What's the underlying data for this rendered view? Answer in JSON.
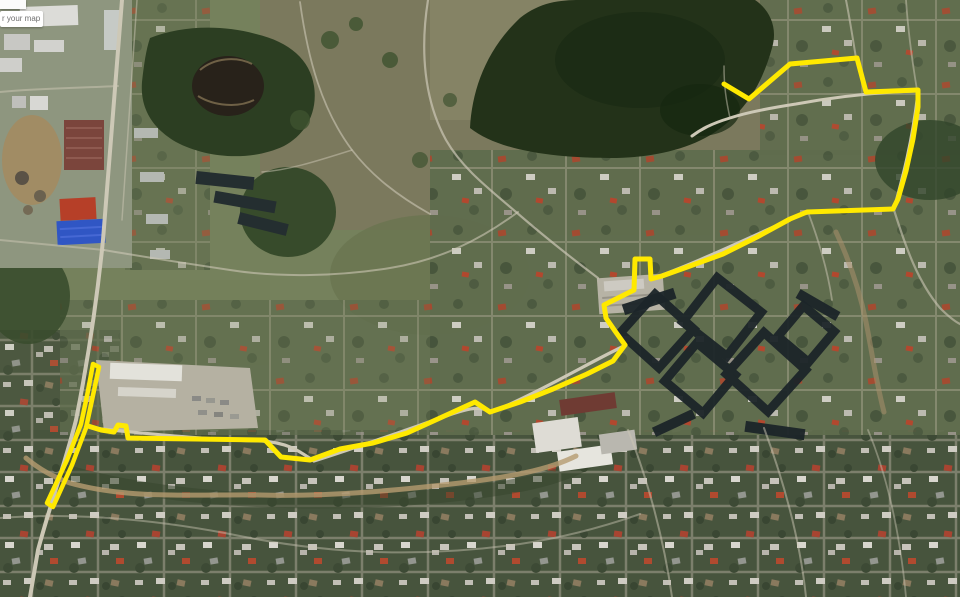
{
  "map_overlay": {
    "partial_label_text": "r your map"
  },
  "route": {
    "color": "#ffe900",
    "width": 5,
    "loop_width": 4.5,
    "main_path": [
      [
        724,
        84
      ],
      [
        749,
        99
      ],
      [
        790,
        64
      ],
      [
        857,
        58
      ],
      [
        866,
        92
      ],
      [
        918,
        90
      ],
      [
        918,
        107
      ],
      [
        913,
        139
      ],
      [
        906,
        171
      ],
      [
        898,
        199
      ],
      [
        893,
        209
      ],
      [
        807,
        212
      ],
      [
        790,
        219
      ],
      [
        757,
        237
      ],
      [
        723,
        254
      ],
      [
        690,
        266
      ],
      [
        662,
        276
      ],
      [
        651,
        279
      ],
      [
        650,
        259
      ],
      [
        635,
        259
      ],
      [
        634,
        290
      ],
      [
        604,
        305
      ],
      [
        606,
        318
      ],
      [
        615,
        331
      ],
      [
        625,
        345
      ],
      [
        613,
        361
      ],
      [
        587,
        374
      ],
      [
        553,
        389
      ],
      [
        520,
        402
      ],
      [
        490,
        412
      ],
      [
        475,
        402
      ],
      [
        440,
        418
      ],
      [
        407,
        433
      ],
      [
        373,
        443
      ],
      [
        340,
        449
      ],
      [
        310,
        460
      ],
      [
        281,
        457
      ],
      [
        265,
        440
      ],
      [
        128,
        438
      ],
      [
        126,
        426
      ],
      [
        118,
        425
      ],
      [
        114,
        432
      ],
      [
        101,
        430
      ],
      [
        88,
        426
      ]
    ],
    "loop_polygon": [
      [
        93,
        364
      ],
      [
        99,
        367
      ],
      [
        92,
        400
      ],
      [
        86,
        428
      ],
      [
        72,
        465
      ],
      [
        53,
        507
      ],
      [
        47,
        503
      ],
      [
        67,
        460
      ],
      [
        81,
        424
      ],
      [
        87,
        396
      ]
    ]
  }
}
